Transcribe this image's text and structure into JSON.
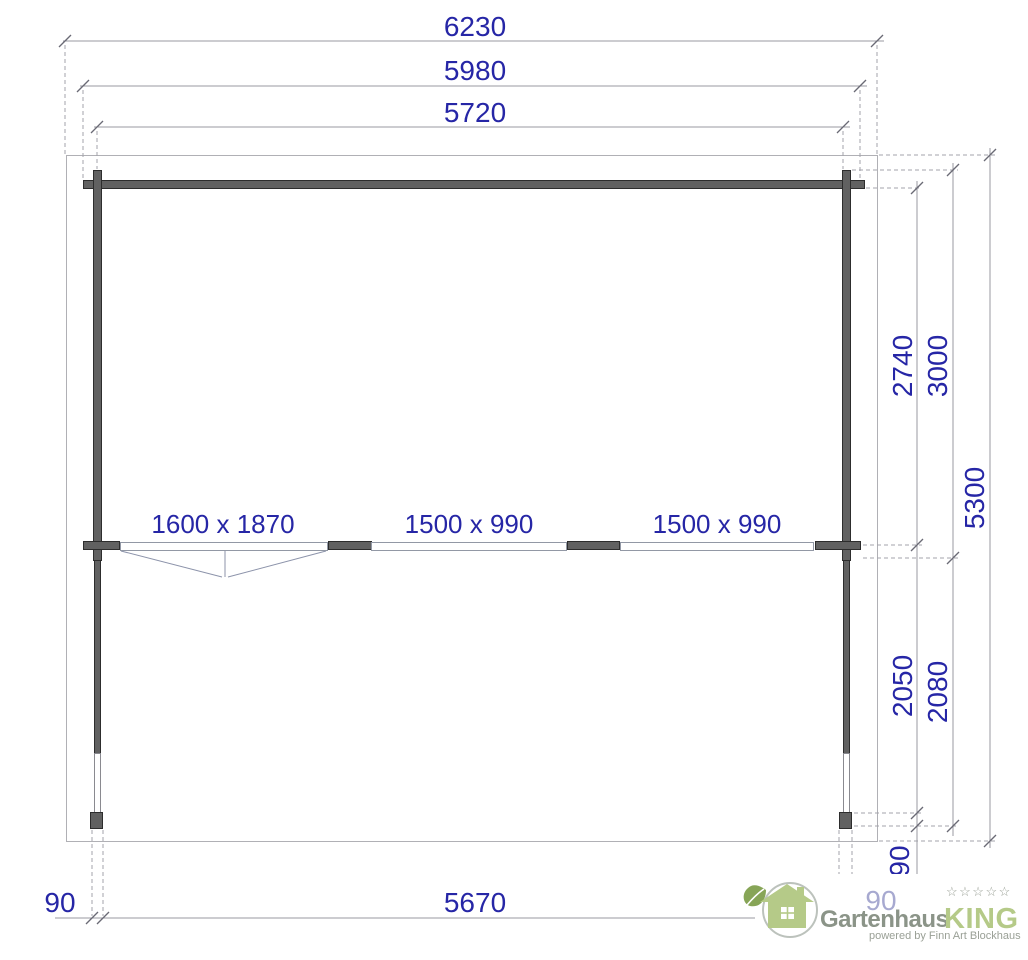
{
  "drawing": {
    "top_dims": [
      {
        "label": "6230"
      },
      {
        "label": "5980"
      },
      {
        "label": "5720"
      }
    ],
    "right_dims": [
      {
        "label": "2740"
      },
      {
        "label": "3000"
      },
      {
        "label": "5300"
      },
      {
        "label": "2050"
      },
      {
        "label": "2080"
      },
      {
        "label": "90"
      }
    ],
    "bottom_dims": [
      {
        "label": "90"
      },
      {
        "label": "5670"
      },
      {
        "label": "90"
      }
    ],
    "openings": [
      {
        "label": "1600 x 1870"
      },
      {
        "label": "1500 x 990"
      },
      {
        "label": "1500 x 990"
      }
    ],
    "colors": {
      "dimension_text": "#2626a6",
      "wall_fill": "#616161",
      "line_gray": "#9898a0"
    }
  },
  "logo": {
    "brand": "Gartenhaus",
    "brand_accent": "KING",
    "stars": "☆☆☆☆☆",
    "tagline": "powered by Finn Art Blockhaus",
    "colors": {
      "green": "#b5ca88",
      "gray": "#8b9488"
    }
  }
}
